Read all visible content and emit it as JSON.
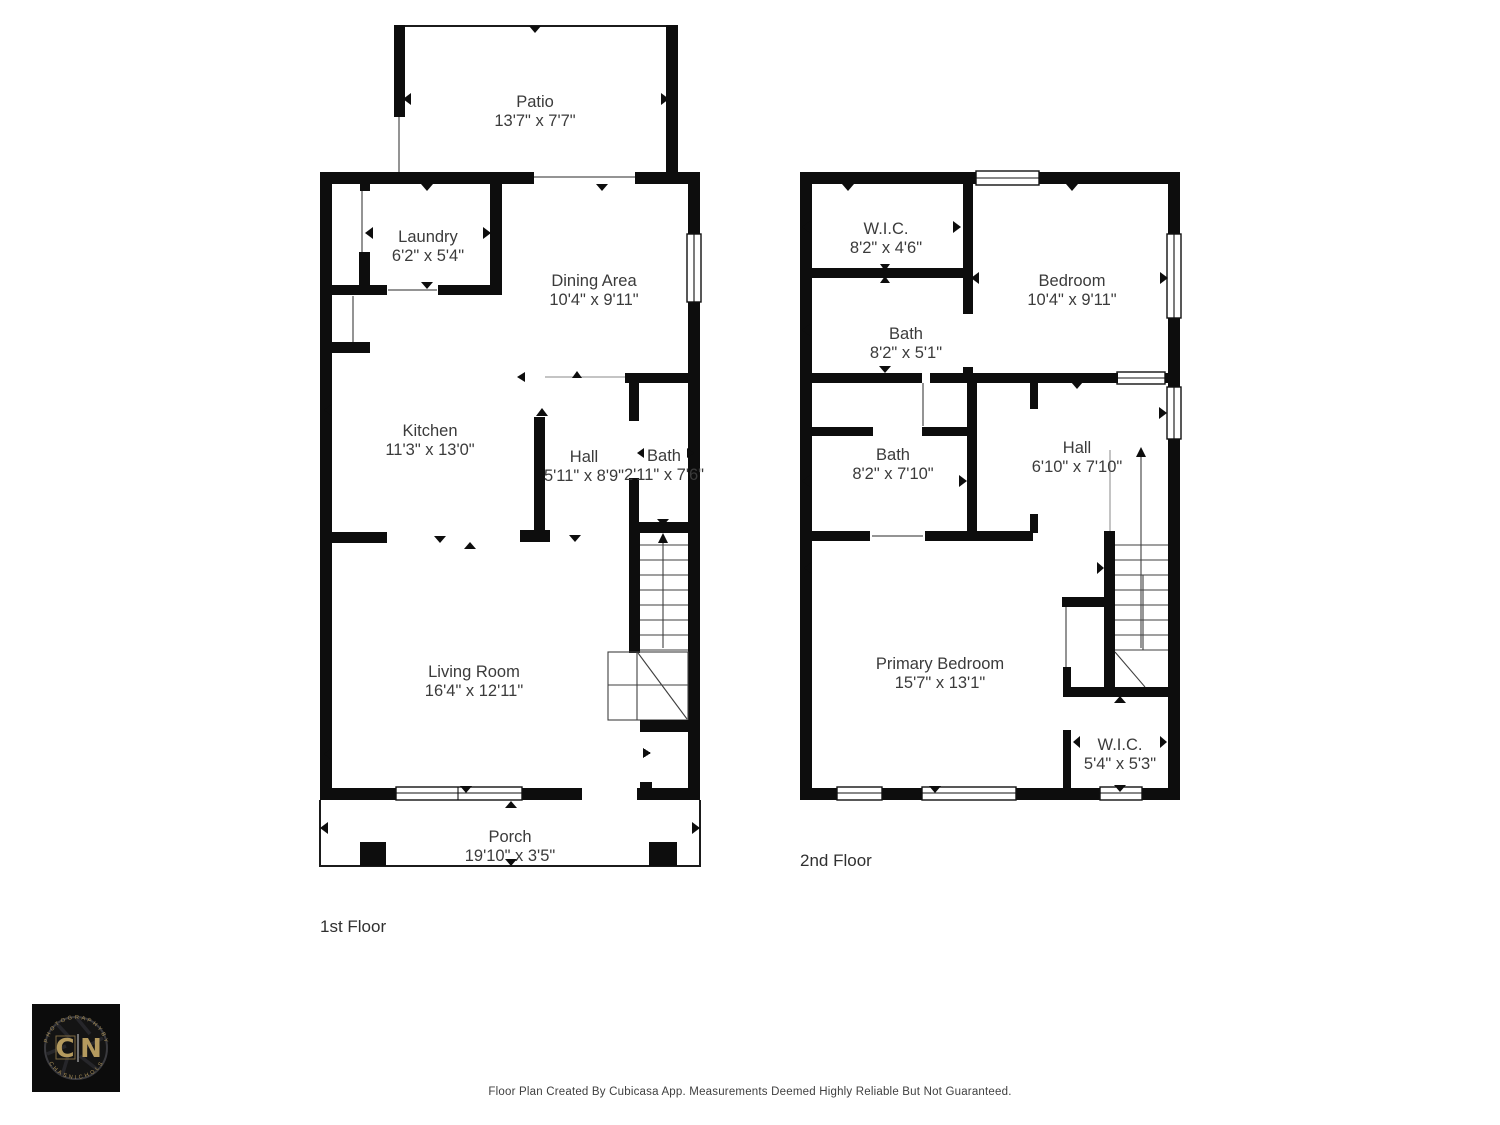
{
  "floors": [
    {
      "label": "1st Floor",
      "rooms": [
        {
          "name": "Patio",
          "dims": "13'7\" x 7'7\""
        },
        {
          "name": "Laundry",
          "dims": "6'2\" x 5'4\""
        },
        {
          "name": "Dining Area",
          "dims": "10'4\" x 9'11\""
        },
        {
          "name": "Kitchen",
          "dims": "11'3\" x 13'0\""
        },
        {
          "name": "Hall",
          "dims": "5'11\" x 8'9\""
        },
        {
          "name": "Bath",
          "dims": "2'11\" x 7'6\""
        },
        {
          "name": "Living Room",
          "dims": "16'4\" x 12'11\""
        },
        {
          "name": "Porch",
          "dims": "19'10\" x 3'5\""
        }
      ]
    },
    {
      "label": "2nd Floor",
      "rooms": [
        {
          "name": "W.I.C.",
          "dims": "8'2\" x 4'6\""
        },
        {
          "name": "Bedroom",
          "dims": "10'4\" x 9'11\""
        },
        {
          "name": "Bath",
          "dims": "8'2\" x 5'1\""
        },
        {
          "name": "Bath",
          "dims": "8'2\" x 7'10\""
        },
        {
          "name": "Hall",
          "dims": "6'10\" x 7'10\""
        },
        {
          "name": "Primary Bedroom",
          "dims": "15'7\" x 13'1\""
        },
        {
          "name": "W.I.C.",
          "dims": "5'4\" x 5'3\""
        }
      ]
    }
  ],
  "footer": {
    "disclaimer": "Floor Plan Created By Cubicasa App. Measurements Deemed Highly Reliable But Not Guaranteed."
  },
  "logo": {
    "initial_left": "C",
    "initial_right": "N",
    "arc_top": "P H O T O G R A P H Y   B Y",
    "arc_bottom": "C H A S   N I C H O L S",
    "gold": "#ab9159"
  },
  "colors": {
    "wall": "#0d0d0d",
    "label_text": "#3b3b3b"
  }
}
